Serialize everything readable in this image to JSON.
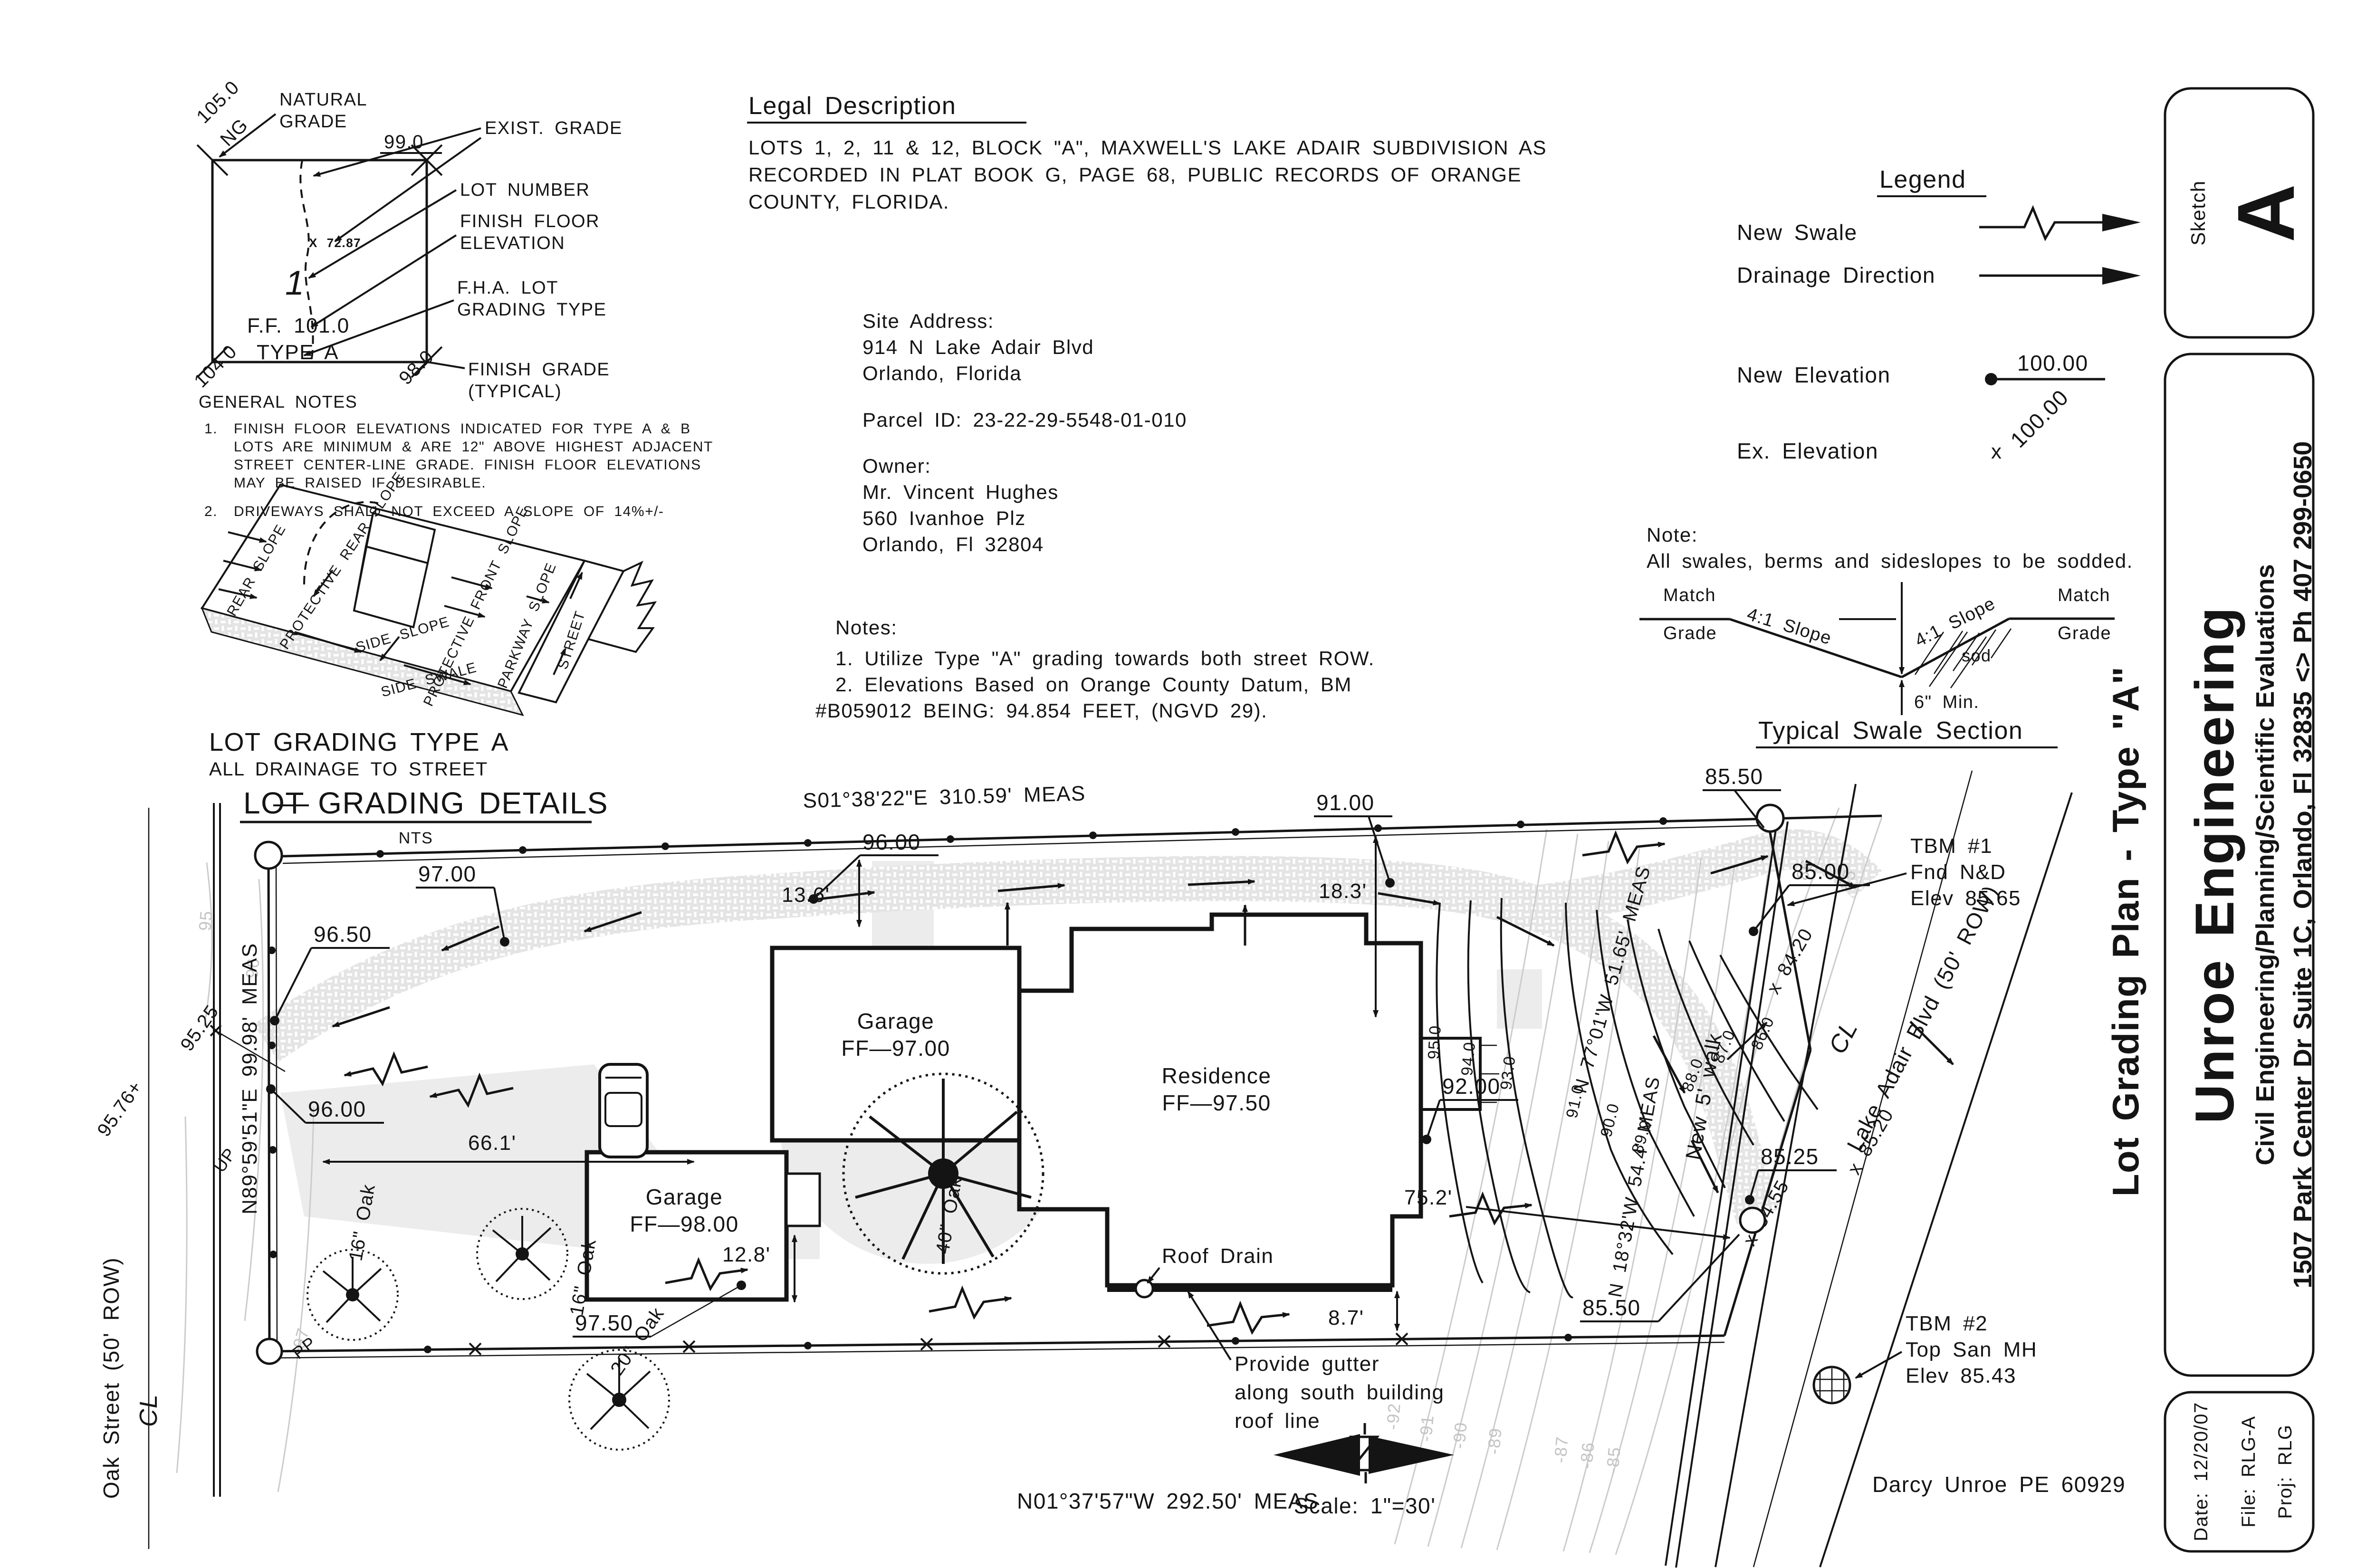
{
  "sheet": {
    "sketch_label": "Sketch",
    "sketch_letter": "A",
    "firm_name": "Unroe Engineering",
    "firm_tagline": "Civil Engineering/Planning/Scientific Evaluations",
    "firm_address": "1507 Park Center Dr Suite 1C, Orlando, Fl 32835 <> Ph 407 299-0650",
    "drawing_title": "Lot Grading Plan - Type \"A\"",
    "date_line": "Date:  12/20/07",
    "file_line": "File:  RLG-A",
    "proj_line": "Proj:  RLG",
    "engineer": "Darcy Unroe PE 60929"
  },
  "detail": {
    "labels": {
      "natural1": "NATURAL",
      "natural2": "GRADE",
      "exist": "EXIST. GRADE",
      "lot_number": "LOT NUMBER",
      "ff1": "FINISH FLOOR",
      "ff2": "ELEVATION",
      "fha1": "F.H.A. LOT",
      "fha2": "GRADING TYPE",
      "fg1": "FINISH GRADE",
      "fg2": "(TYPICAL)",
      "ng_val": "105.0",
      "ng": "NG",
      "tr": "99.0",
      "bl": "104.0",
      "br": "98.0",
      "lot_no": "1",
      "ff_val": "F.F. 101.0",
      "type": "TYPE A",
      "spot": "X 72.87"
    },
    "general_notes_title": "GENERAL NOTES",
    "gn1_num": "1.",
    "gn1_l1": "FINISH FLOOR ELEVATIONS INDICATED FOR TYPE A & B",
    "gn1_l2": "LOTS ARE MINIMUM & ARE 12\" ABOVE HIGHEST ADJACENT",
    "gn1_l3": "STREET CENTER-LINE GRADE. FINISH FLOOR ELEVATIONS",
    "gn1_l4": "MAY BE RAISED IF DESIRABLE.",
    "gn2_num": "2.",
    "gn2_l1": "DRIVEWAYS SHALL NOT EXCEED A SLOPE OF 14%+/-",
    "axon": {
      "rear": "REAR SLOPE",
      "prot_rear": "PROTECTIVE REAR SLOPE",
      "side": "SIDE SLOPE",
      "swale": "SIDE SWALE",
      "prot_front": "PROTECTIVE FRONT SLOPE",
      "parkway": "PARKWAY SLOPE",
      "street": "STREET"
    },
    "type_title": "LOT GRADING TYPE A",
    "type_sub": "ALL DRAINAGE TO STREET",
    "main_title": "LOT GRADING DETAILS",
    "nts": "NTS"
  },
  "legal": {
    "title": "Legal Description",
    "body1": "LOTS 1, 2, 11 & 12, BLOCK \"A\", MAXWELL'S LAKE ADAIR SUBDIVISION AS",
    "body2": "RECORDED IN PLAT BOOK G, PAGE 68, PUBLIC RECORDS OF ORANGE",
    "body3": "COUNTY, FLORIDA.",
    "site_label": "Site Address:",
    "site1": "914 N Lake Adair Blvd",
    "site2": "Orlando, Florida",
    "parcel": "Parcel ID: 23-22-29-5548-01-010",
    "owner_label": "Owner:",
    "owner1": "Mr. Vincent Hughes",
    "owner2": "560 Ivanhoe Plz",
    "owner3": "Orlando, Fl 32804",
    "notes_title": "Notes:",
    "note1": "1.   Utilize Type \"A\" grading towards both street ROW.",
    "note2a": "2.   Elevations Based on Orange County Datum, BM",
    "note2b": "#B059012 BEING: 94.854 FEET, (NGVD 29)."
  },
  "legend": {
    "title": "Legend",
    "new_swale": "New Swale",
    "drainage": "Drainage Direction",
    "new_elev": "New Elevation",
    "new_elev_val": "100.00",
    "ex_elev": "Ex. Elevation",
    "ex_elev_val": "100.00",
    "ex_mark": "x"
  },
  "swale_section": {
    "note_title": "Note:",
    "note_body": "All swales, berms and sideslopes to be sodded.",
    "match1": "Match",
    "grade1": "Grade",
    "match2": "Match",
    "grade2": "Grade",
    "slope_l": "4:1 Slope",
    "slope_r": "4:1 Slope",
    "sod": "sod",
    "min": "6\" Min.",
    "title": "Typical Swale Section"
  },
  "plan": {
    "bearing_top": "S01°38'22\"E  310.59'  MEAS",
    "bearing_west": "N89°59'51\"E  99.98'  MEAS",
    "bearing_south": "N01°37'57\"W  292.50'  MEAS",
    "bearing_ne": "N 77°01'W  51.65'  MEAS",
    "bearing_e": "N 18°32'W  54.4'  MEAS",
    "oak_street": "Oak  Street  (50'  ROW)",
    "lake_blvd": "Lake  Adair  Blvd  (50'  ROW)",
    "new_walk": "New 5' walk",
    "cl": "CL",
    "e9600t": "96.00",
    "d136": "13.6'",
    "e9100": "91.00",
    "d183": "18.3'",
    "e8550t": "85.50",
    "e8500": "85.00",
    "tbm1a": "TBM #1",
    "tbm1b": "Fnd N&D",
    "tbm1c": "Elev 85.65",
    "x8420": "x 84.20",
    "e9525": "95.25",
    "e9576": "95.76+",
    "e9700": "97.00",
    "e9650": "96.50",
    "e9600": "96.00",
    "d661": "66.1'",
    "garage1a": "Garage",
    "garage1b": "FF—97.00",
    "resa": "Residence",
    "resb": "FF—97.50",
    "garage2a": "Garage",
    "garage2b": "FF—98.00",
    "oak40": "40\" Oak",
    "oak16a": "16\" Oak",
    "oak16b": "16\" Oak",
    "oak20": "20\" Oak",
    "d128": "12.8'",
    "e9750": "97.50",
    "roof_drain": "Roof Drain",
    "d87": "8.7'",
    "gutter1": "Provide gutter",
    "gutter2": "along south building",
    "gutter3": "roof line",
    "scale_text": "Scale:  1\"=30'",
    "e9200": "92.00",
    "d752": "75.2'",
    "e8525": "85.25",
    "x8455": "x 84.55",
    "x8520": "x 85.20",
    "e8550b": "85.50",
    "tbm2a": "TBM #2",
    "tbm2b": "Top San MH",
    "tbm2c": "Elev 85.43",
    "pp": "PP",
    "up": "UP",
    "gray_west": [
      "95",
      "96",
      "97"
    ],
    "gray_east": [
      "86",
      "85"
    ],
    "gray_bottom": [
      "-92",
      "-91",
      "-90",
      "-89",
      "-87",
      "-86",
      "-85"
    ],
    "black_contours": [
      "95.0",
      "94.0",
      "93.0",
      "91.0",
      "90.0",
      "89.0",
      "88.0",
      "87.0",
      "86.0"
    ]
  }
}
